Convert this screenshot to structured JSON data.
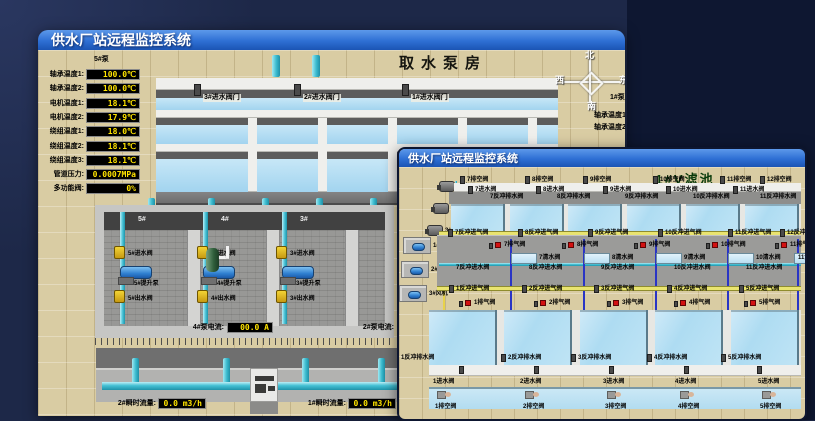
{
  "back_window": {
    "title": "供水厂站远程监控系统",
    "scene_title": "取水泵房",
    "pump_panel": {
      "header": "5#泵",
      "rows": [
        {
          "label": "轴承温度1:",
          "value": "100.0℃"
        },
        {
          "label": "轴承温度2:",
          "value": "100.0℃"
        },
        {
          "label": "电机温度1:",
          "value": "18.1℃"
        },
        {
          "label": "电机温度2:",
          "value": "17.9℃"
        },
        {
          "label": "绕组温度1:",
          "value": "18.0℃"
        },
        {
          "label": "绕组温度2:",
          "value": "18.1℃"
        },
        {
          "label": "绕组温度3:",
          "value": "18.1℃"
        },
        {
          "label": "管道压力:",
          "value": "0.0007MPa"
        },
        {
          "label": "多功能阀:",
          "value": "0%"
        }
      ]
    },
    "intake_valves": [
      "3#进水阀门",
      "2#进水阀门",
      "1#进水阀门"
    ],
    "compass": {
      "north": "北",
      "west": "西",
      "south": "南",
      "east": "东"
    },
    "right_panel": {
      "header": "1#泵",
      "labels": [
        "轴承温度1:",
        "轴承温度2:"
      ]
    },
    "pump_room": {
      "bays": [
        {
          "name": "5#",
          "inlet": "5#进水阀",
          "pump": "5#提升泵",
          "outlet": "5#出水阀"
        },
        {
          "name": "4#",
          "inlet": "4#进水阀",
          "pump": "4#提升泵",
          "outlet": "4#出水阀"
        },
        {
          "name": "3#",
          "inlet": "3#进水阀",
          "pump": "3#提升泵",
          "outlet": "3#出水阀"
        }
      ]
    },
    "current_readouts": [
      {
        "label": "4#泵电流:",
        "value": "00.0 A"
      },
      {
        "label": "2#泵电流:",
        "value": ""
      }
    ],
    "flow_readouts": [
      {
        "label": "2#瞬时流量:",
        "value": "0.0 m3/h"
      },
      {
        "label": "1#瞬时流量:",
        "value": "0.0 m3/h"
      }
    ]
  },
  "front_window": {
    "title": "供水厂站远程监控系统",
    "scene_title": "1#V滤池",
    "equipment": [
      {
        "label": "1#水泵",
        "type": "pump"
      },
      {
        "label": "2#水泵",
        "type": "pump"
      },
      {
        "label": "3#水泵",
        "type": "pump"
      },
      {
        "label": "1#风机",
        "type": "blower"
      },
      {
        "label": "2#风机",
        "type": "blower"
      },
      {
        "label": "3#风机",
        "type": "blower"
      }
    ],
    "top_cells": {
      "drain_valves": [
        "7排空阀",
        "8排空阀",
        "9排空阀",
        "10排空阀",
        "11排空阀",
        "12排空阀"
      ],
      "inlet_valves": [
        "7进水阀",
        "8进水阀",
        "9进水阀",
        "10进水阀",
        "11进水阀"
      ],
      "backwash_drain_valves": [
        "7反冲排水阀",
        "8反冲排水阀",
        "9反冲排水阀",
        "10反冲排水阀",
        "11反冲排水阀"
      ],
      "backwash_air_valves": [
        "7反冲进气阀",
        "8反冲进气阀",
        "9反冲进气阀",
        "10反冲进气阀",
        "11反冲进气阀",
        "12反冲进气阀"
      ],
      "air_release_valves": [
        "7排气阀",
        "8排气阀",
        "9排气阀",
        "10排气阀",
        "11排气阀"
      ],
      "clear_water_valves": [
        "7清水阀",
        "8清水阀",
        "9清水阀",
        "10清水阀",
        "11清水阀"
      ],
      "backwash_water_valves": [
        "7反冲进水阀",
        "8反冲进水阀",
        "9反冲进水阀",
        "10反冲进水阀",
        "11反冲进水阀"
      ]
    },
    "bottom_cells": {
      "backwash_air_valves": [
        "1反冲进气阀",
        "2反冲进气阀",
        "3反冲进气阀",
        "4反冲进气阀",
        "5反冲进气阀"
      ],
      "air_release_valves": [
        "1排气阀",
        "2排气阀",
        "3排气阀",
        "4排气阀",
        "5排气阀"
      ],
      "backwash_drain_valves": [
        "1反冲排水阀",
        "2反冲排水阀",
        "3反冲排水阀",
        "4反冲排水阀",
        "5反冲排水阀"
      ],
      "inlet_valves": [
        "1进水阀",
        "2进水阀",
        "3进水阀",
        "4进水阀",
        "5进水阀"
      ],
      "drain_valves": [
        "1排空阀",
        "2排空阀",
        "3排空阀",
        "4排空阀",
        "5排空阀"
      ]
    }
  }
}
